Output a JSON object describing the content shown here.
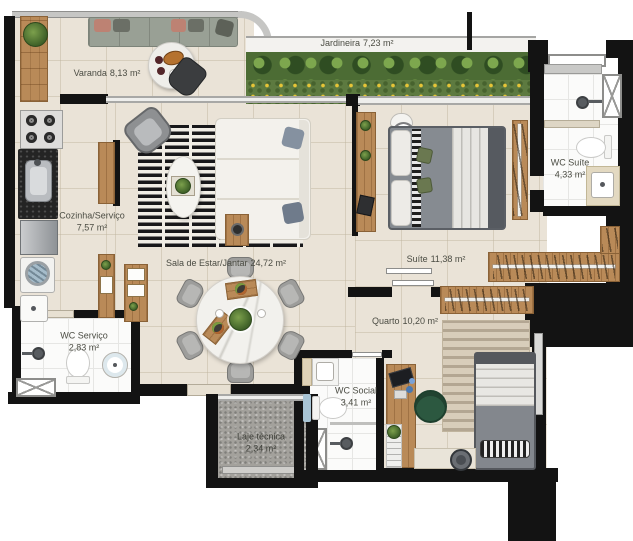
{
  "floorplan": {
    "rooms": {
      "varanda": {
        "name": "Varanda",
        "area": "8,13 m²"
      },
      "jardineira": {
        "name": "Jardineira",
        "area": "7,23 m²"
      },
      "cozinha_servico": {
        "name": "Cozinha/Serviço",
        "area": "7,57 m²"
      },
      "sala": {
        "name": "Sala de Estar/Jantar",
        "area": "24,72 m²"
      },
      "suite": {
        "name": "Suíte",
        "area": "11,38 m²"
      },
      "wc_suite": {
        "name": "WC Suíte",
        "area": "4,33 m²"
      },
      "quarto": {
        "name": "Quarto",
        "area": "10,20 m²"
      },
      "wc_servico": {
        "name": "WC Serviço",
        "area": "2,83 m²"
      },
      "wc_social": {
        "name": "WC Social",
        "area": "3,41 m²"
      },
      "laje_tecnica": {
        "name": "Laje técnica",
        "area": "2,34 m²"
      }
    },
    "palette": {
      "wall": "#131313",
      "floor": "#eae3d7",
      "bath_floor": "#fbfbfa",
      "wood": "#b98a58",
      "greenery": "#4f7a35",
      "laje": "#a3a19c",
      "rug_dark": "#18181a",
      "label_text": "#4b4c43"
    }
  }
}
